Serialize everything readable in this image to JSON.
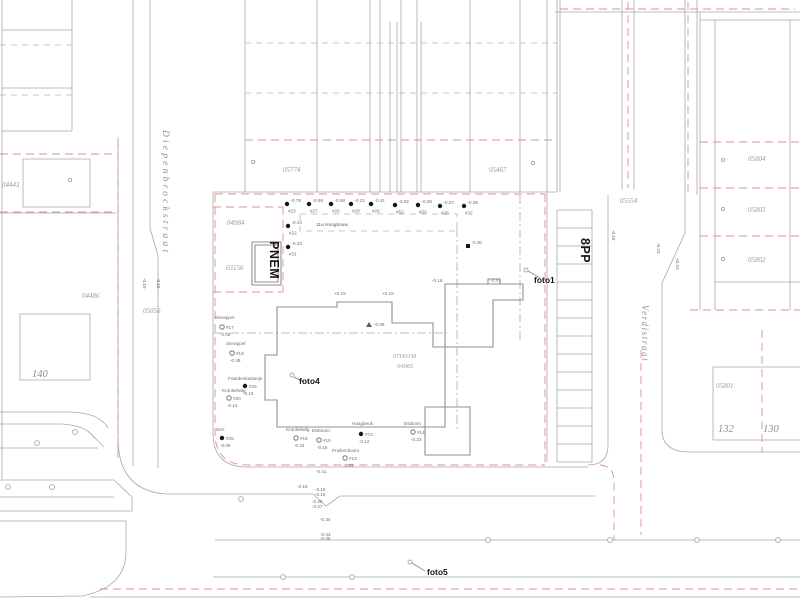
{
  "colors": {
    "background": "#ffffff",
    "line_gray": "#a8a8a8",
    "boundary_red": "#de8f8f",
    "building_gray": "#8f8f8f",
    "text_gray": "#9b9b9b",
    "annotation_black": "#161616"
  },
  "labels": {
    "street_names": [
      {
        "text": "Diepenbrockstraat",
        "x": 163,
        "y": 130,
        "rot": 90
      },
      {
        "text": "Verdistraat",
        "x": 642,
        "y": 305,
        "rot": 90
      }
    ],
    "bold": [
      {
        "text": "PNEM",
        "x": 270,
        "y": 241,
        "rot": 90
      },
      {
        "text": "8PP",
        "x": 581,
        "y": 238,
        "rot": 90
      },
      {
        "text": "foto1",
        "x": 534,
        "y": 283,
        "rot": 0
      },
      {
        "text": "foto4",
        "x": 299,
        "y": 384,
        "rot": 0
      },
      {
        "text": "foto5",
        "x": 427,
        "y": 575,
        "rot": 0
      }
    ],
    "parcels": [
      {
        "text": "04443",
        "x": 2,
        "y": 187
      },
      {
        "text": "04486",
        "x": 82,
        "y": 298
      },
      {
        "text": "05056",
        "x": 143,
        "y": 313
      },
      {
        "text": "04984",
        "x": 227,
        "y": 225
      },
      {
        "text": "03156",
        "x": 226,
        "y": 270
      },
      {
        "text": "05774",
        "x": 283,
        "y": 172
      },
      {
        "text": "05467",
        "x": 489,
        "y": 172
      },
      {
        "text": "05554",
        "x": 620,
        "y": 203
      },
      {
        "text": "05804",
        "x": 748,
        "y": 161
      },
      {
        "text": "05803",
        "x": 748,
        "y": 212
      },
      {
        "text": "05802",
        "x": 748,
        "y": 262
      },
      {
        "text": "05801",
        "x": 716,
        "y": 388
      },
      {
        "text": "07H01M",
        "x": 393,
        "y": 358
      },
      {
        "text": "04965",
        "x": 397,
        "y": 368
      }
    ],
    "houses": [
      {
        "text": "140",
        "x": 32,
        "y": 377
      },
      {
        "text": "132",
        "x": 718,
        "y": 432
      },
      {
        "text": "130",
        "x": 763,
        "y": 432
      }
    ],
    "building_label": {
      "text": "11a  Hoogbouw",
      "x": 316,
      "y": 226
    }
  },
  "survey_points": [
    {
      "m": "dot",
      "x": 287,
      "y": 204,
      "elev": "-0.78",
      "tag": "#23"
    },
    {
      "m": "dot",
      "x": 309,
      "y": 204,
      "elev": "-0.68",
      "tag": "#27"
    },
    {
      "m": "dot",
      "x": 331,
      "y": 204,
      "elev": "-0.58",
      "tag": "#26"
    },
    {
      "m": "dot",
      "x": 351,
      "y": 204,
      "elev": "-0.21",
      "tag": "#28"
    },
    {
      "m": "dot",
      "x": 371,
      "y": 204,
      "elev": "-0.41",
      "tag": "#29"
    },
    {
      "m": "dot",
      "x": 395,
      "y": 205,
      "elev": "-0.02",
      "tag": "#52"
    },
    {
      "m": "dot",
      "x": 418,
      "y": 205,
      "elev": "-0.06",
      "tag": "#50"
    },
    {
      "m": "dot",
      "x": 440,
      "y": 206,
      "elev": "-0.07",
      "tag": "#28"
    },
    {
      "m": "dot",
      "x": 464,
      "y": 206,
      "elev": "-0.06",
      "tag": "#32"
    },
    {
      "m": "dot",
      "x": 288,
      "y": 226,
      "elev": "-0.34",
      "tag": "#22"
    },
    {
      "m": "dot",
      "x": 288,
      "y": 247,
      "elev": "-0.33",
      "tag": "#31"
    },
    {
      "m": "square",
      "x": 468,
      "y": 246,
      "elev": "-0.30",
      "tag": ""
    }
  ],
  "trees": [
    {
      "name": "Sierappel",
      "nx": 215,
      "ny": 319,
      "m": "circle",
      "x": 222,
      "y": 327,
      "tag": "#17",
      "elev": "-0.09"
    },
    {
      "name": "Sierappel",
      "nx": 226,
      "ny": 345,
      "m": "circle",
      "x": 232,
      "y": 353,
      "tag": "#19",
      "elev": "-0.49"
    },
    {
      "name": "Paardenkastanje",
      "nx": 228,
      "ny": 380,
      "m": "dot",
      "x": 245,
      "y": 386,
      "tag": "#26",
      "elev": "-0.16"
    },
    {
      "name": "Kronkelwilg",
      "nx": 222,
      "ny": 392,
      "m": "circle",
      "x": 229,
      "y": 398,
      "tag": "#20",
      "elev": "-0.14"
    },
    {
      "name": "Den",
      "nx": 216,
      "ny": 431,
      "m": "dot",
      "x": 222,
      "y": 438,
      "tag": "#25",
      "elev": "-0.09"
    },
    {
      "name": "Kronkelwilg",
      "nx": 286,
      "ny": 431,
      "m": "circle",
      "x": 296,
      "y": 438,
      "tag": "#18",
      "elev": "-0.24"
    },
    {
      "name": "Elsboom",
      "nx": 312,
      "ny": 432,
      "m": "circle",
      "x": 319,
      "y": 440,
      "tag": "#15",
      "elev": "-0.16"
    },
    {
      "name": "Pruikenboom",
      "nx": 332,
      "ny": 452,
      "m": "circle",
      "x": 345,
      "y": 458,
      "tag": "#13",
      "elev": "-0.25"
    },
    {
      "name": "Haagbeuk",
      "nx": 352,
      "ny": 425,
      "m": "dot",
      "x": 361,
      "y": 434,
      "tag": "#72",
      "elev": "-0.12"
    },
    {
      "name": "Esdoorn",
      "nx": 404,
      "ny": 425,
      "m": "circle",
      "x": 413,
      "y": 432,
      "tag": "#14",
      "elev": "-0.23"
    }
  ],
  "elev_marks": [
    {
      "t": "+0.15",
      "x": 334,
      "y": 295,
      "rot": 0
    },
    {
      "t": "+0.16",
      "x": 382,
      "y": 295,
      "rot": 0
    },
    {
      "t": "-0.16",
      "x": 432,
      "y": 282,
      "rot": 0
    },
    {
      "t": "-0.47",
      "x": 490,
      "y": 282,
      "rot": 0
    },
    {
      "t": "-0.09",
      "x": 374,
      "y": 326,
      "rot": 0
    },
    {
      "t": "-0.41",
      "x": 316,
      "y": 473,
      "rot": 0
    },
    {
      "t": "-0.19",
      "x": 297,
      "y": 488,
      "rot": 0
    },
    {
      "t": "-0.16",
      "x": 315,
      "y": 491,
      "rot": 0
    },
    {
      "t": "-0.16",
      "x": 315,
      "y": 496,
      "rot": 0
    },
    {
      "t": "-0.26",
      "x": 312,
      "y": 503,
      "rot": 0
    },
    {
      "t": "-0.27",
      "x": 312,
      "y": 508,
      "rot": 0
    },
    {
      "t": "-0.34",
      "x": 320,
      "y": 521,
      "rot": 0
    },
    {
      "t": "-0.43",
      "x": 320,
      "y": 536,
      "rot": 0
    },
    {
      "t": "-0.36",
      "x": 320,
      "y": 540,
      "rot": 0
    },
    {
      "t": "-0.19",
      "x": 143,
      "y": 278,
      "rot": 90
    },
    {
      "t": "-0.15",
      "x": 157,
      "y": 278,
      "rot": 90
    },
    {
      "t": "-0.18",
      "x": 612,
      "y": 230,
      "rot": 90
    },
    {
      "t": "-0.24",
      "x": 657,
      "y": 243,
      "rot": 90
    },
    {
      "t": "+0.15",
      "x": 676,
      "y": 258,
      "rot": 90
    }
  ],
  "symbols": [
    {
      "x": 253,
      "y": 162
    },
    {
      "x": 533,
      "y": 163
    },
    {
      "x": 70,
      "y": 180
    },
    {
      "x": 723,
      "y": 160
    },
    {
      "x": 723,
      "y": 209
    },
    {
      "x": 723,
      "y": 259
    }
  ]
}
